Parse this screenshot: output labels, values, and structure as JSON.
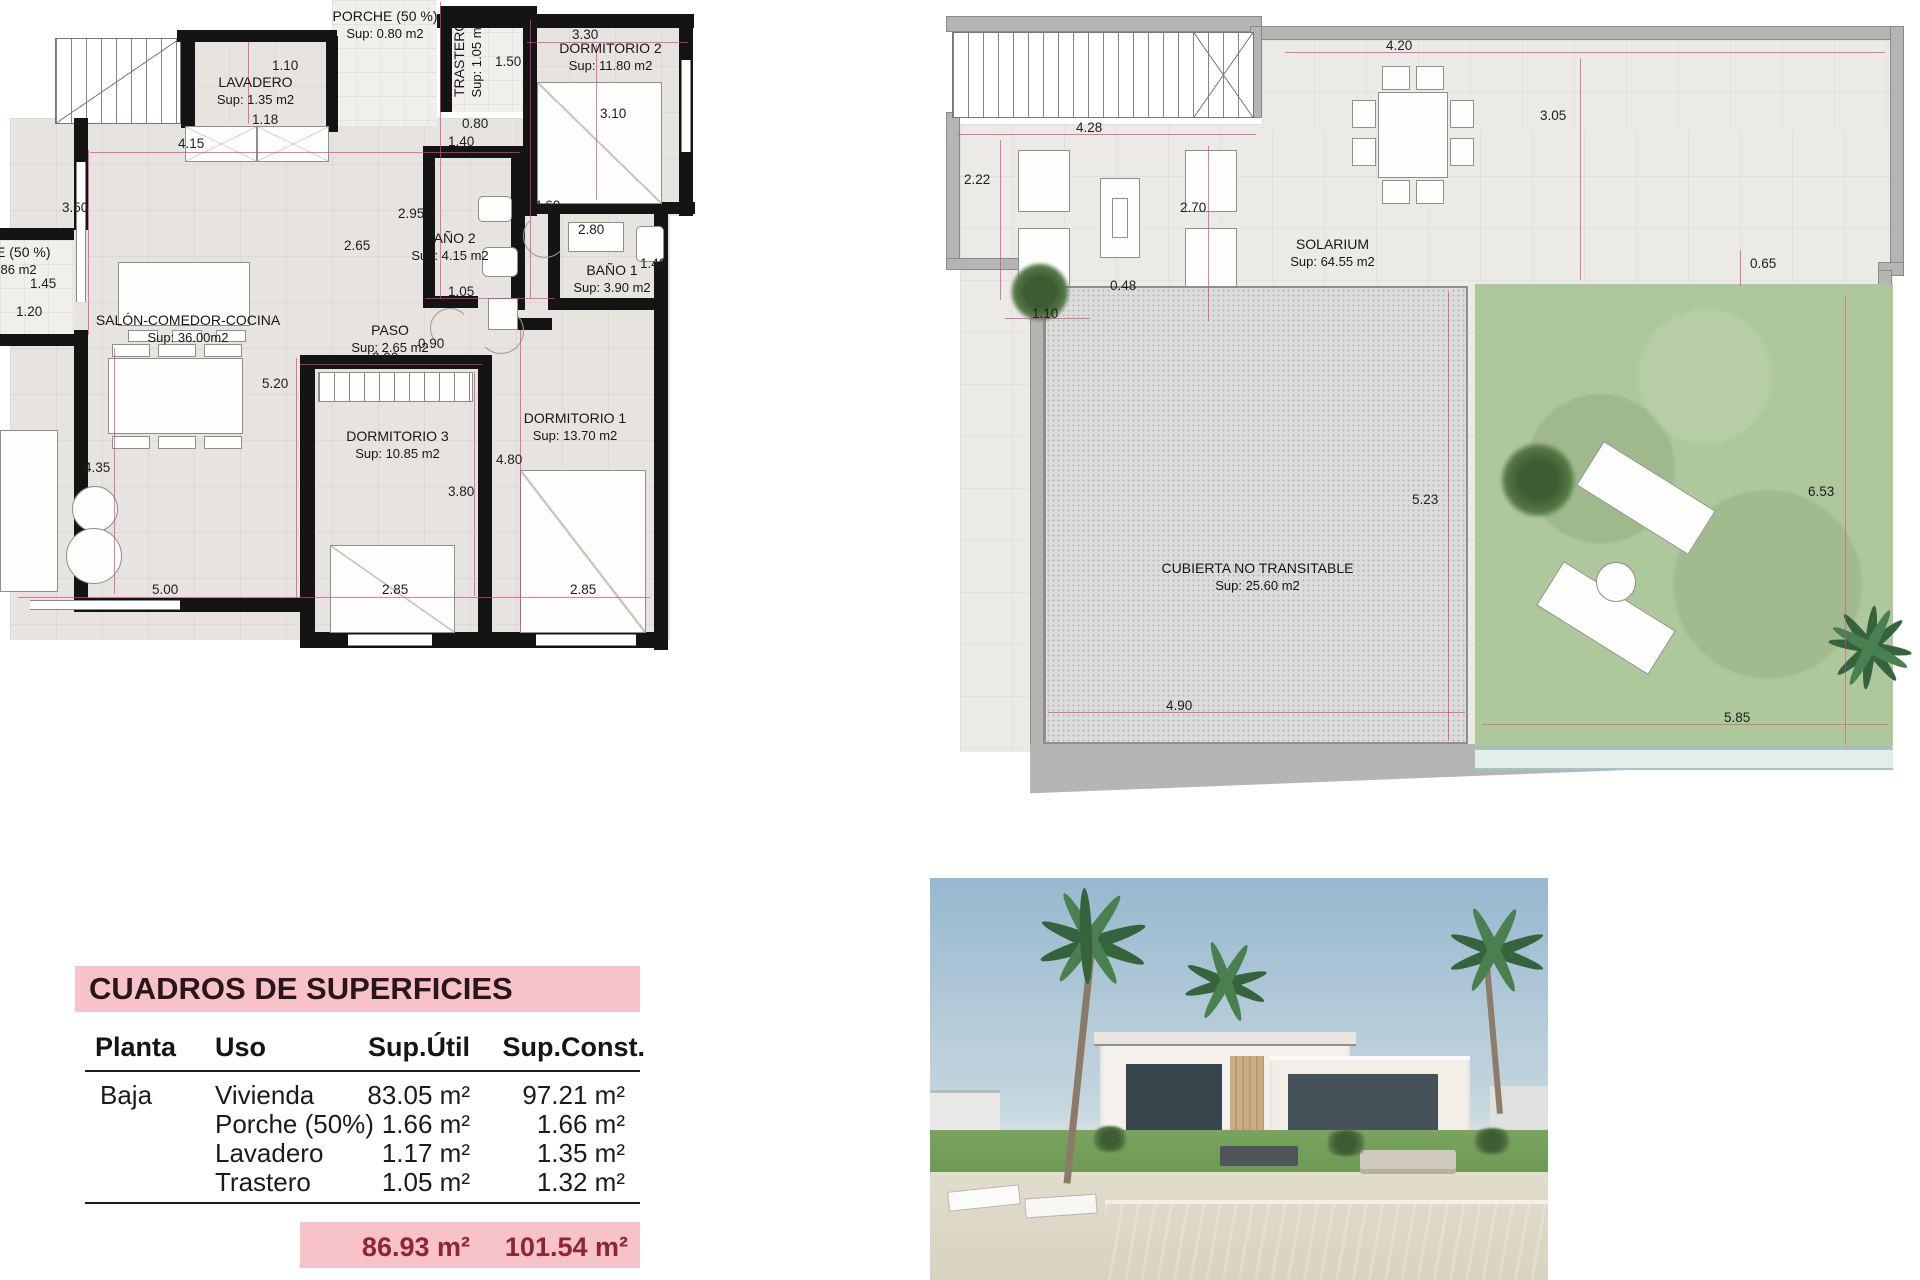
{
  "floor_plan": {
    "rooms": {
      "porche_top": {
        "name": "PORCHE (50 %)",
        "area": "Sup: 0.80 m2"
      },
      "lavadero": {
        "name": "LAVADERO",
        "area": "Sup: 1.35 m2"
      },
      "trastero": {
        "name": "TRASTERO",
        "area": "Sup: 1.05 m2"
      },
      "dormitorio2": {
        "name": "DORMITORIO 2",
        "area": "Sup: 11.80 m2"
      },
      "bano2": {
        "name": "BAÑO 2",
        "area": "Sup: 4.15 m2"
      },
      "bano1": {
        "name": "BAÑO 1",
        "area": "Sup: 3.90 m2"
      },
      "porche_left": {
        "name": "PORCHE (50 %)",
        "area": "Sup: 0.86 m2"
      },
      "salon": {
        "name": "SALÓN-COMEDOR-COCINA",
        "area": "Sup: 36.00m2"
      },
      "paso": {
        "name": "PASO",
        "area": "Sup: 2.65 m2"
      },
      "dormitorio3": {
        "name": "DORMITORIO 3",
        "area": "Sup: 10.85 m2"
      },
      "dormitorio1": {
        "name": "DORMITORIO 1",
        "area": "Sup: 13.70 m2"
      }
    },
    "dims": {
      "d_1_10": "1.10",
      "d_1_18": "1.18",
      "d_4_15": "4.15",
      "d_3_50": "3.50",
      "d_2_65": "2.65",
      "d_1_40a": "1.40",
      "d_2_95": "2.95",
      "d_4_60": "4.60",
      "d_3_30": "3.30",
      "d_3_10": "3.10",
      "d_1_50": "1.50",
      "d_0_80": "0.80",
      "d_2_80": "2.80",
      "d_1_40b": "1.40",
      "d_1_05": "1.05",
      "d_0_90": "0.90",
      "d_3_00": "3.00",
      "d_5_20": "5.20",
      "d_4_80": "4.80",
      "d_3_80": "3.80",
      "d_1_45": "1.45",
      "d_1_20": "1.20",
      "d_4_35": "4.35",
      "d_5_00": "5.00",
      "d_2_85a": "2.85",
      "d_2_85b": "2.85"
    }
  },
  "roof_plan": {
    "solarium": {
      "name": "SOLARIUM",
      "area": "Sup: 64.55 m2"
    },
    "cubierta": {
      "name": "CUBIERTA NO TRANSITABLE",
      "area": "Sup: 25.60 m2"
    },
    "dims": {
      "d_4_20": "4.20",
      "d_3_05": "3.05",
      "d_4_28": "4.28",
      "d_2_22": "2.22",
      "d_2_70": "2.70",
      "d_0_48": "0.48",
      "d_1_10": "1.10",
      "d_0_65": "0.65",
      "d_5_23": "5.23",
      "d_4_90": "4.90",
      "d_6_53": "6.53",
      "d_5_85": "5.85"
    }
  },
  "areas_table": {
    "title": "CUADROS DE SUPERFICIES",
    "headers": {
      "planta": "Planta",
      "uso": "Uso",
      "util": "Sup.Útil",
      "const": "Sup.Const."
    },
    "rows": [
      {
        "planta": "Baja",
        "uso": "Vivienda",
        "util": "83.05 m²",
        "const": "97.21 m²"
      },
      {
        "planta": "",
        "uso": "Porche (50%)",
        "util": "1.66 m²",
        "const": "1.66 m²"
      },
      {
        "planta": "",
        "uso": "Lavadero",
        "util": "1.17 m²",
        "const": "1.35 m²"
      },
      {
        "planta": "",
        "uso": "Trastero",
        "util": "1.05 m²",
        "const": "1.32 m²"
      }
    ],
    "total": {
      "util": "86.93 m²",
      "const": "101.54 m²"
    }
  },
  "colors": {
    "dimension_line": "#e0418a",
    "wall": "#141414",
    "table_highlight": "#f8c2c9",
    "total_text": "#8e2533",
    "lawn": "#aec79b",
    "pool": "#66c2bd"
  }
}
